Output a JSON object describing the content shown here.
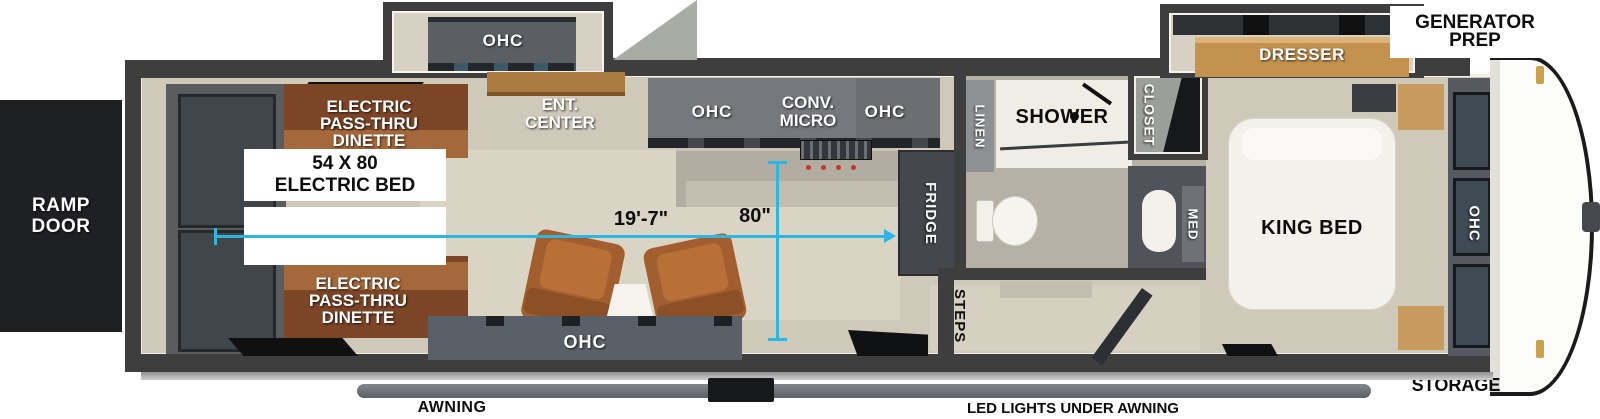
{
  "exterior": {
    "ramp_door": "RAMP\nDOOR",
    "generator_prep": "GENERATOR\nPREP",
    "storage": "STORAGE",
    "awning": "AWNING",
    "led_lights": "LED LIGHTS UNDER AWNING"
  },
  "garage": {
    "dinette_top": "ELECTRIC\nPASS-THRU\nDINETTE",
    "dinette_bottom": "ELECTRIC\nPASS-THRU\nDINETTE",
    "electric_bed": "54 X 80\nELECTRIC BED",
    "slide_ohc": "OHC",
    "ent_center": "ENT.\nCENTER",
    "sofa_ohc": "OHC"
  },
  "kitchen": {
    "ohc_left": "OHC",
    "conv_micro": "CONV.\nMICRO",
    "ohc_right": "OHC",
    "fridge": "FRIDGE"
  },
  "bath": {
    "linen": "LINEN",
    "shower": "SHOWER",
    "closet": "CLOSET",
    "med": "MED"
  },
  "entry": {
    "steps": "STEPS"
  },
  "bedroom": {
    "dresser": "DRESSER",
    "king_bed": "KING BED",
    "front_ohc": "OHC"
  },
  "dimensions": {
    "garage_length": "19'-7\"",
    "interior_width": "80\""
  },
  "colors": {
    "dimension_line": "#2fb6e0",
    "wall": "#3e3e3e",
    "floor": "#cfc9ba",
    "dinette": "#7c4526",
    "cabinet": "#75787c",
    "accent_wood": "#c3924f"
  }
}
